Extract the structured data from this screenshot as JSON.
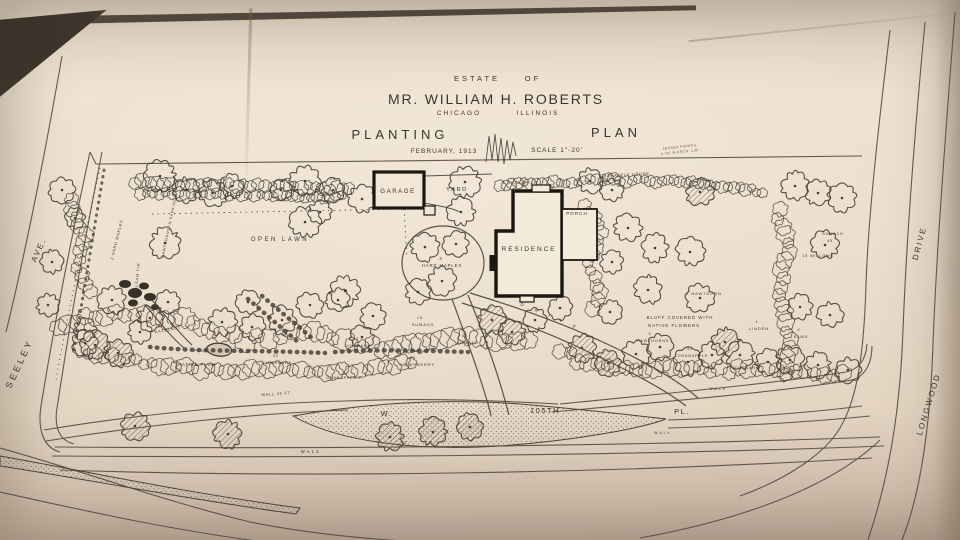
{
  "title": {
    "estate": "ESTATE",
    "of": "OF",
    "name": "MR. WILLIAM H. ROBERTS",
    "city": "CHICAGO",
    "state": "ILLINOIS",
    "word_planting": "PLANTING",
    "word_plan": "PLAN",
    "date": "FEBRUARY, 1913",
    "scale": "SCALE 1\"-20'",
    "stamp_line1": "JENSEN PAPERS",
    "stamp_line2": "U OF M ARCH. LIB."
  },
  "streets": {
    "seeley": "SEELEY",
    "ave": "AVE.",
    "longwood": "LONGWOOD",
    "drive": "DRIVE",
    "w": "W.",
    "num": "105TH",
    "pl": "PL.",
    "walk": "WALK"
  },
  "buildings": {
    "garage": "GARAGE",
    "yard": "YARD",
    "residence": "RESIDENCE",
    "porch": "PORCH"
  },
  "areas": {
    "open_lawn": "OPEN LAWN"
  },
  "colors": {
    "ink": "#463f35",
    "building": "#1b1712",
    "paper_fill": "#f2e7d6"
  },
  "plant_labels": [
    {
      "text": "3",
      "x": 441,
      "y": 260,
      "size": 4.5
    },
    {
      "text": "HARD MAPLES",
      "x": 442,
      "y": 267,
      "size": 4.2
    },
    {
      "text": "1 CRABAPPLE",
      "x": 520,
      "y": 184,
      "size": 3.8
    },
    {
      "text": "CRABAPPLE HEDGE",
      "x": 625,
      "y": 176,
      "size": 3.8,
      "rot": -3
    },
    {
      "text": "1 HAWTHORN",
      "x": 704,
      "y": 295,
      "size": 4
    },
    {
      "text": "BLUFF COVERED WITH",
      "x": 680,
      "y": 319,
      "size": 4.4
    },
    {
      "text": "NATIVE FLOWERS",
      "x": 674,
      "y": 327,
      "size": 4.4
    },
    {
      "text": "1",
      "x": 757,
      "y": 323,
      "size": 4
    },
    {
      "text": "LINDEN",
      "x": 759,
      "y": 330,
      "size": 4
    },
    {
      "text": "2",
      "x": 799,
      "y": 331,
      "size": 4
    },
    {
      "text": "ELMS",
      "x": 801,
      "y": 338,
      "size": 4
    },
    {
      "text": "2",
      "x": 650,
      "y": 335,
      "size": 4
    },
    {
      "text": "HAWTHORNS",
      "x": 653,
      "y": 342,
      "size": 3.8
    },
    {
      "text": "30",
      "x": 690,
      "y": 350,
      "size": 3.8
    },
    {
      "text": "CRABAPPLE",
      "x": 693,
      "y": 357,
      "size": 3.8
    },
    {
      "text": "NINEBARK",
      "x": 746,
      "y": 369,
      "size": 3.8
    },
    {
      "text": "15",
      "x": 420,
      "y": 319,
      "size": 4
    },
    {
      "text": "SUMACH",
      "x": 423,
      "y": 326,
      "size": 4
    },
    {
      "text": "52",
      "x": 465,
      "y": 337,
      "size": 4
    },
    {
      "text": "SUMACH",
      "x": 468,
      "y": 344,
      "size": 4
    },
    {
      "text": "10",
      "x": 356,
      "y": 340,
      "size": 3.8
    },
    {
      "text": "NINEBARK",
      "x": 358,
      "y": 347,
      "size": 3.8
    },
    {
      "text": "50",
      "x": 413,
      "y": 359,
      "size": 4
    },
    {
      "text": "SHEEPBERRY",
      "x": 417,
      "y": 366,
      "size": 4
    },
    {
      "text": "NATIVE PLUM",
      "x": 197,
      "y": 366,
      "size": 4.2
    },
    {
      "text": "POOL",
      "x": 201,
      "y": 352,
      "size": 3.6
    },
    {
      "text": "32",
      "x": 276,
      "y": 357,
      "size": 3.8
    },
    {
      "text": "NINEBARK",
      "x": 279,
      "y": 364,
      "size": 3.8
    },
    {
      "text": "CRABAPPLE 2",
      "x": 344,
      "y": 379,
      "size": 3.8
    },
    {
      "text": "HAZELNUT",
      "x": 168,
      "y": 331,
      "size": 3.8,
      "rot": -10
    },
    {
      "text": "2 HARD MAPLES",
      "x": 118,
      "y": 240,
      "size": 3.8,
      "rot": -76
    },
    {
      "text": "HAWTHORNS IN PARKING",
      "x": 170,
      "y": 228,
      "size": 3.6,
      "rot": -78
    },
    {
      "text": "14 BALSAM FIR",
      "x": 138,
      "y": 282,
      "size": 3.8,
      "rot": -84
    },
    {
      "text": "45",
      "x": 284,
      "y": 181,
      "size": 3.8
    },
    {
      "text": "28",
      "x": 333,
      "y": 180,
      "size": 3.8
    },
    {
      "text": "WALL 45 FT.",
      "x": 277,
      "y": 395,
      "size": 3.8,
      "rot": -4
    },
    {
      "text": "SUMACH",
      "x": 833,
      "y": 235,
      "size": 3.8
    },
    {
      "text": "45",
      "x": 830,
      "y": 242,
      "size": 3.8
    },
    {
      "text": "15 WILLOWS",
      "x": 818,
      "y": 257,
      "size": 3.8
    },
    {
      "text": "40",
      "x": 404,
      "y": 444,
      "size": 3.6
    },
    {
      "text": "D",
      "x": 522,
      "y": 306,
      "size": 4.4,
      "rot": 24
    },
    {
      "text": "R",
      "x": 536,
      "y": 312,
      "size": 4.4,
      "rot": 26
    },
    {
      "text": "I",
      "x": 549,
      "y": 317,
      "size": 4.4,
      "rot": 27
    },
    {
      "text": "V",
      "x": 561,
      "y": 322,
      "size": 4.4,
      "rot": 28
    },
    {
      "text": "E",
      "x": 574,
      "y": 328,
      "size": 4.4,
      "rot": 30
    }
  ],
  "trees": [
    [
      160,
      176,
      13,
      0
    ],
    [
      186,
      190,
      11,
      0
    ],
    [
      213,
      193,
      12,
      0
    ],
    [
      232,
      186,
      10,
      0
    ],
    [
      281,
      190,
      9,
      0
    ],
    [
      305,
      181,
      13,
      0
    ],
    [
      333,
      190,
      10,
      0
    ],
    [
      362,
      199,
      12,
      0
    ],
    [
      320,
      212,
      10,
      0
    ],
    [
      62,
      190,
      11,
      0
    ],
    [
      75,
      218,
      9,
      0
    ],
    [
      52,
      262,
      10,
      0
    ],
    [
      48,
      305,
      10,
      0
    ],
    [
      165,
      243,
      13,
      0
    ],
    [
      112,
      300,
      12,
      0
    ],
    [
      150,
      318,
      11,
      0
    ],
    [
      85,
      330,
      10,
      0
    ],
    [
      95,
      345,
      12,
      1
    ],
    [
      118,
      353,
      12,
      1
    ],
    [
      305,
      222,
      13,
      0
    ],
    [
      345,
      291,
      13,
      0
    ],
    [
      373,
      316,
      11,
      0
    ],
    [
      418,
      292,
      11,
      0
    ],
    [
      465,
      182,
      13,
      0
    ],
    [
      461,
      212,
      12,
      0
    ],
    [
      425,
      247,
      12,
      0
    ],
    [
      456,
      244,
      11,
      0
    ],
    [
      442,
      281,
      12,
      0
    ],
    [
      590,
      181,
      11,
      0
    ],
    [
      612,
      190,
      10,
      0
    ],
    [
      700,
      192,
      12,
      1
    ],
    [
      628,
      228,
      12,
      0
    ],
    [
      655,
      248,
      12,
      0
    ],
    [
      690,
      252,
      12,
      0
    ],
    [
      612,
      262,
      10,
      0
    ],
    [
      648,
      290,
      12,
      0
    ],
    [
      700,
      298,
      12,
      0
    ],
    [
      610,
      312,
      10,
      0
    ],
    [
      725,
      342,
      12,
      1
    ],
    [
      795,
      186,
      12,
      0
    ],
    [
      818,
      193,
      11,
      0
    ],
    [
      842,
      198,
      12,
      0
    ],
    [
      825,
      245,
      12,
      0
    ],
    [
      800,
      307,
      11,
      0
    ],
    [
      830,
      315,
      11,
      0
    ],
    [
      790,
      360,
      12,
      0
    ],
    [
      818,
      365,
      11,
      0
    ],
    [
      848,
      370,
      11,
      0
    ],
    [
      85,
      343,
      11,
      0
    ],
    [
      140,
      332,
      10,
      0
    ],
    [
      168,
      302,
      10,
      0
    ],
    [
      222,
      322,
      12,
      0
    ],
    [
      252,
      327,
      11,
      0
    ],
    [
      282,
      320,
      12,
      0
    ],
    [
      248,
      302,
      10,
      0
    ],
    [
      310,
      305,
      11,
      0
    ],
    [
      338,
      300,
      10,
      0
    ],
    [
      362,
      337,
      10,
      0
    ],
    [
      492,
      320,
      12,
      1
    ],
    [
      512,
      332,
      11,
      1
    ],
    [
      535,
      320,
      10,
      0
    ],
    [
      560,
      308,
      10,
      0
    ],
    [
      582,
      348,
      12,
      1
    ],
    [
      608,
      363,
      11,
      1
    ],
    [
      636,
      354,
      12,
      0
    ],
    [
      660,
      347,
      11,
      0
    ],
    [
      688,
      362,
      12,
      0
    ],
    [
      712,
      355,
      11,
      0
    ],
    [
      740,
      355,
      12,
      0
    ],
    [
      768,
      362,
      11,
      0
    ],
    [
      135,
      426,
      12,
      1
    ],
    [
      228,
      434,
      12,
      1
    ],
    [
      390,
      437,
      12,
      1
    ],
    [
      433,
      432,
      12,
      1
    ],
    [
      470,
      427,
      11,
      1
    ]
  ],
  "shrub_belts": [
    {
      "r": 5,
      "pts": [
        [
          135,
          182
        ],
        [
          200,
          184
        ],
        [
          265,
          186
        ],
        [
          330,
          188
        ],
        [
          355,
          190
        ]
      ]
    },
    {
      "r": 4.5,
      "pts": [
        [
          140,
          193
        ],
        [
          210,
          195
        ],
        [
          280,
          196
        ],
        [
          348,
          197
        ]
      ]
    },
    {
      "r": 4.5,
      "pts": [
        [
          500,
          184
        ],
        [
          560,
          182
        ],
        [
          620,
          180
        ],
        [
          680,
          182
        ],
        [
          740,
          188
        ],
        [
          768,
          193
        ]
      ]
    },
    {
      "r": 6,
      "pts": [
        [
          585,
          205
        ],
        [
          600,
          232
        ],
        [
          590,
          262
        ],
        [
          602,
          292
        ],
        [
          592,
          318
        ]
      ]
    },
    {
      "r": 6.5,
      "pts": [
        [
          778,
          210
        ],
        [
          788,
          252
        ],
        [
          777,
          296
        ],
        [
          792,
          340
        ],
        [
          780,
          382
        ]
      ]
    },
    {
      "r": 7.5,
      "pts": [
        [
          58,
          325
        ],
        [
          95,
          316
        ],
        [
          135,
          313
        ],
        [
          175,
          318
        ],
        [
          210,
          330
        ],
        [
          245,
          340
        ],
        [
          280,
          334
        ],
        [
          315,
          330
        ],
        [
          352,
          344
        ],
        [
          392,
          348
        ],
        [
          430,
          340
        ],
        [
          468,
          338
        ],
        [
          505,
          343
        ],
        [
          540,
          336
        ]
      ]
    },
    {
      "r": 7,
      "pts": [
        [
          560,
          352
        ],
        [
          598,
          366
        ],
        [
          636,
          370
        ],
        [
          672,
          366
        ],
        [
          710,
          372
        ],
        [
          748,
          368
        ],
        [
          786,
          372
        ],
        [
          824,
          374
        ],
        [
          852,
          376
        ]
      ]
    },
    {
      "r": 6,
      "pts": [
        [
          80,
          352
        ],
        [
          128,
          360
        ],
        [
          176,
          367
        ],
        [
          226,
          372
        ],
        [
          276,
          368
        ],
        [
          326,
          372
        ],
        [
          376,
          367
        ],
        [
          420,
          362
        ]
      ]
    },
    {
      "r": 6,
      "pts": [
        [
          70,
          200
        ],
        [
          84,
          234
        ],
        [
          77,
          268
        ],
        [
          93,
          300
        ]
      ]
    }
  ]
}
